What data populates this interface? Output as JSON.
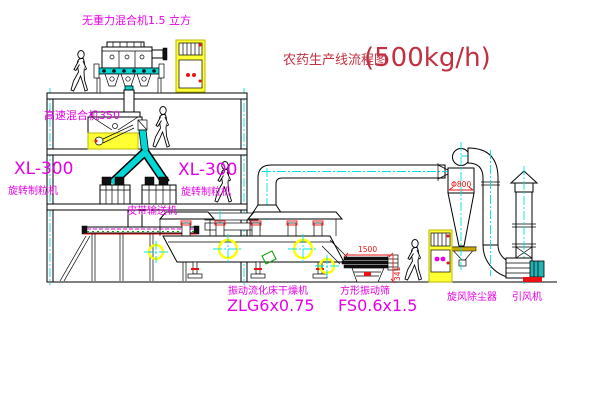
{
  "title": {
    "name": "农药生产线流程图",
    "capacity": "(500kg/h)"
  },
  "equipment_labels": {
    "gravity_mixer": "无重力混合机1.5 立方",
    "high_speed_mixer": "高速混合机350",
    "granulator_left_model": "XL-300",
    "granulator_left_name": "旋转制粒机",
    "granulator_right_model": "XL-300",
    "granulator_right_name": "旋转制粒机",
    "belt_conveyor": "皮带输送机",
    "dryer_name": "振动流化床干燥机",
    "dryer_model": "ZLG6x0.75",
    "sieve_name": "方形振动筛",
    "sieve_model": "FS0.6x1.5",
    "cyclone_name": "旋风除尘器",
    "fan_name": "引风机"
  },
  "dimensions": {
    "sieve_length": "1500",
    "sieve_height": "341",
    "cyclone_diameter": "Φ800"
  },
  "colors": {
    "label_magenta": "#e800e8",
    "title_red": "#c23040",
    "dimension_red": "#ee1111",
    "centerline_cyan": "#00e0e0",
    "pipe_cyan": "#00d8d8",
    "cabinet_yellow": "#ffff33",
    "motor_teal": "#25b2b2",
    "highlight_yellow": "#ffff00"
  }
}
